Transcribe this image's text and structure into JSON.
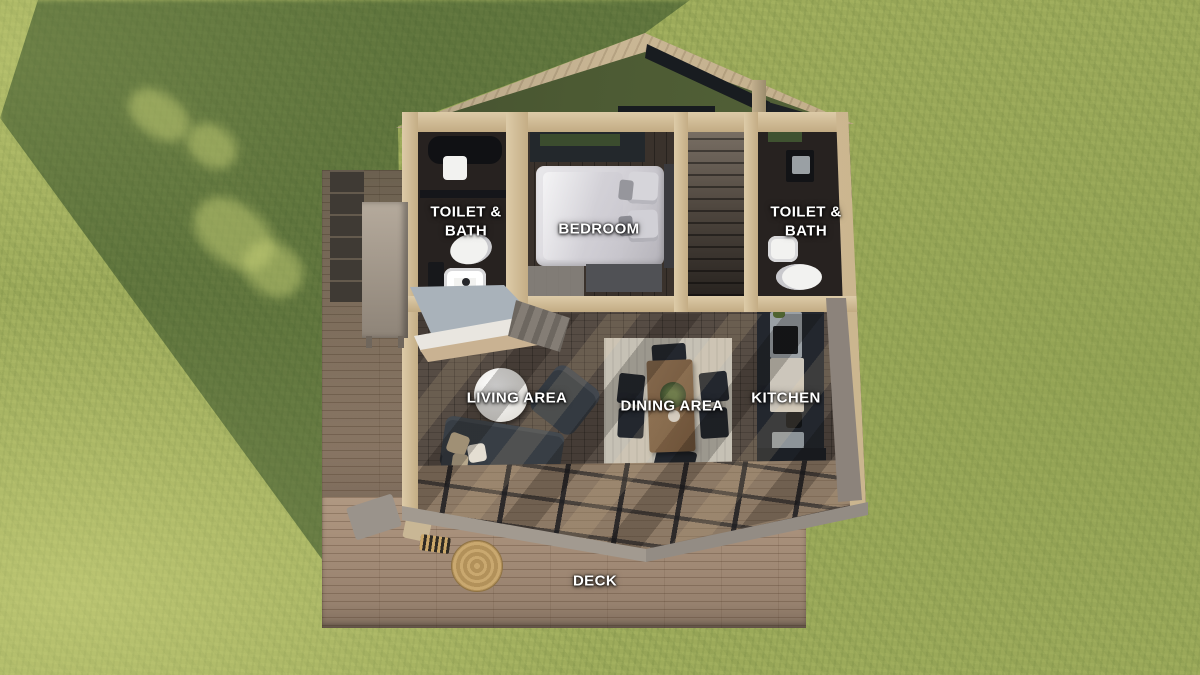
{
  "scene": {
    "type": "3d-floor-plan-aerial-render",
    "description": "Top-down 3D render of a small gabled cabin floor plan on a grass lawn with wooden deck"
  },
  "rooms": [
    {
      "id": "toilet-bath-left",
      "label": "TOILET & BATH"
    },
    {
      "id": "bedroom",
      "label": "BEDROOM"
    },
    {
      "id": "toilet-bath-right",
      "label": "TOILET & BATH"
    },
    {
      "id": "living-area",
      "label": "LIVING AREA"
    },
    {
      "id": "dining-area",
      "label": "DINING AREA"
    },
    {
      "id": "kitchen",
      "label": "KITCHEN"
    },
    {
      "id": "deck",
      "label": "DECK"
    }
  ],
  "palette": {
    "grass_light": "#a3b05e",
    "grass_shadow": "#51703f",
    "deck_wood": "#a78f7a",
    "wall_wood_cut": "#d6c3a0",
    "interior_dark_floor": "#2a2523",
    "living_floor": "#564c44",
    "kitchen_cabinets": "#23272e",
    "fascia_grey": "#968f88",
    "label_text": "#ffffff"
  }
}
